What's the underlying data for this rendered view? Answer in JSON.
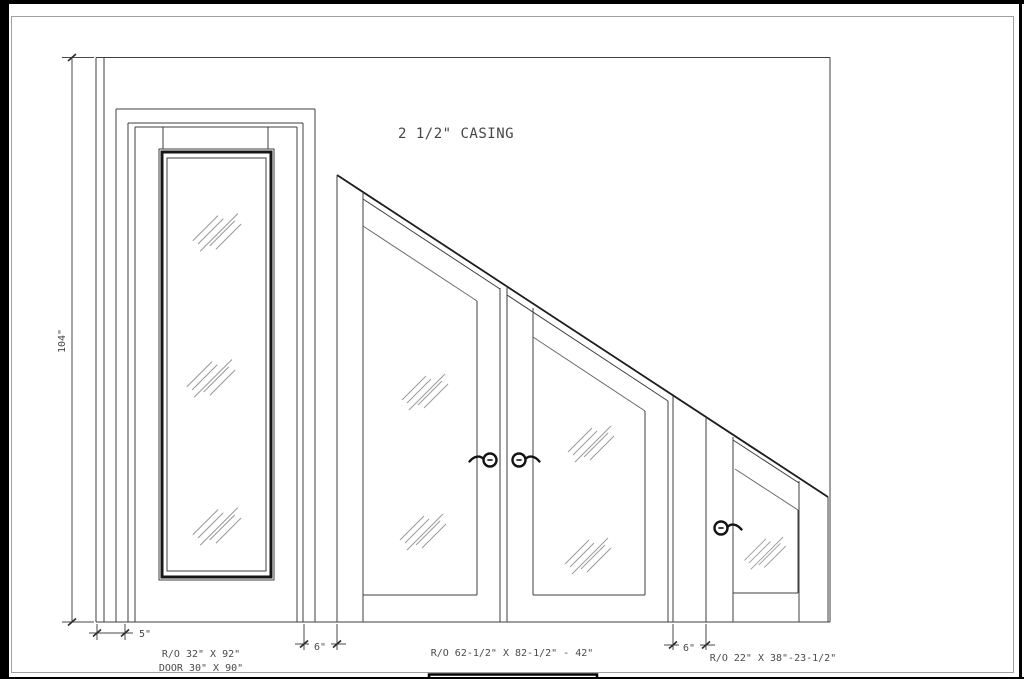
{
  "drawing": {
    "casing_note": "2 1/2\" CASING",
    "colors": {
      "line": "#3f3f3f",
      "heavy_line": "#1c1c1c",
      "glass_hatch": "#9a9a9a",
      "frame": "#000000",
      "text": "#4a4a4a",
      "background": "#ffffff"
    }
  },
  "dimensions": {
    "wall_height": "104\"",
    "left_casing_offset": "5\"",
    "gap_left": "6\"",
    "gap_right": "6\""
  },
  "labels": {
    "tall_door_ro": "R/O 32\" X 92\"",
    "tall_door_size": "DOOR 30\" X 90\"",
    "double_door_ro": "R/O 62-1/2\" X 82-1/2\" - 42\"",
    "small_door_ro": "R/O 22\" X 38\"-23-1/2\""
  }
}
